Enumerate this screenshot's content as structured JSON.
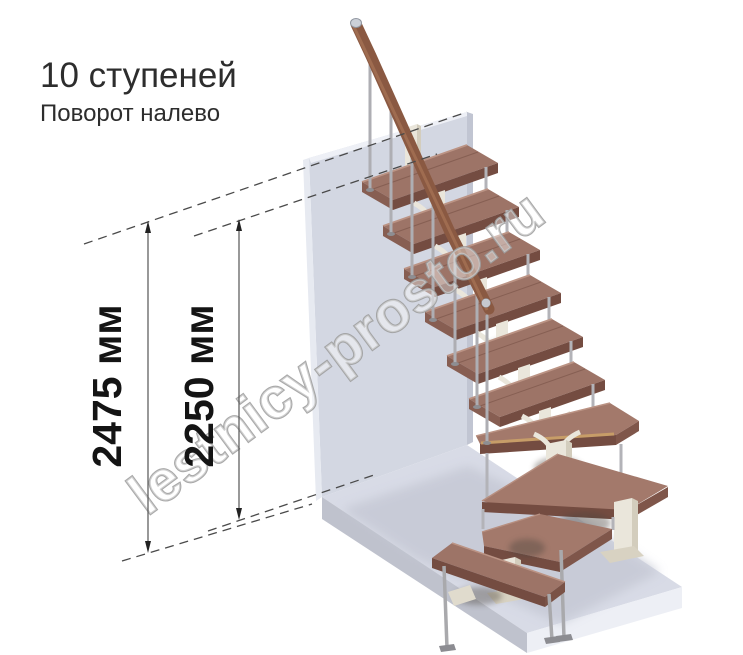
{
  "title": "10 ступеней",
  "subtitle": "Поворот налево",
  "watermark": "lestnicy-prosto.ru",
  "dimensions": {
    "total_height": "2475 мм",
    "flight_height": "2250 мм"
  },
  "illustration": {
    "steps_count": 10,
    "turn_direction": "налево"
  },
  "colors": {
    "wall": "#d3d7e2",
    "floor": "#d8dbe6",
    "tread": "#9d7467",
    "handrail": "#8a5942",
    "metal": "#b3b3b8",
    "frame": "#eae6db",
    "dimension_text": "#141414"
  }
}
